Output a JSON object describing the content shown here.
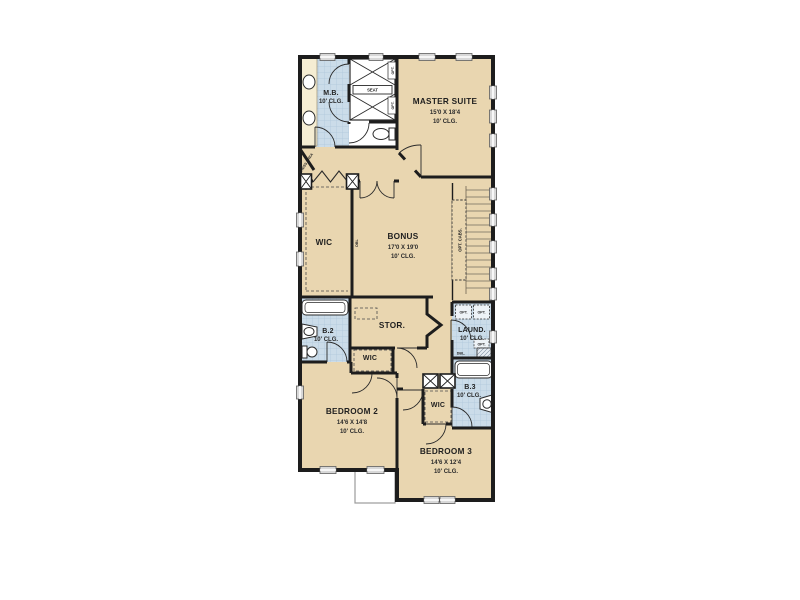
{
  "plan": {
    "type": "residential-floor-plan",
    "colors": {
      "wall": "#1d1d1d",
      "floor_tan": "#e9d6b0",
      "tile_blue": "#cbdce9",
      "vanity_cream": "#f5edd3",
      "background": "#ffffff",
      "window_gray": "#d8d8d8"
    }
  },
  "rooms": {
    "master_bath": {
      "name": "M.B.",
      "ceiling": "10' CLG."
    },
    "master_suite": {
      "name": "MASTER SUITE",
      "dims": "15'0 X 18'4",
      "ceiling": "10' CLG."
    },
    "wic_master": {
      "name": "WIC"
    },
    "bonus": {
      "name": "BONUS",
      "dims": "17'0 X 19'0",
      "ceiling": "10' CLG."
    },
    "bath2": {
      "name": "B.2",
      "ceiling": "10' CLG."
    },
    "storage": {
      "name": "STOR."
    },
    "laundry": {
      "name": "LAUND.",
      "ceiling": "10' CLG."
    },
    "wic_bed2": {
      "name": "WIC"
    },
    "bath3": {
      "name": "B.3",
      "ceiling": "10' CLG."
    },
    "wic_bed3": {
      "name": "WIC"
    },
    "bedroom2": {
      "name": "BEDROOM 2",
      "dims": "14'6 X 14'8",
      "ceiling": "10' CLG."
    },
    "bedroom3": {
      "name": "BEDROOM 3",
      "dims": "14'6 X 12'4",
      "ceiling": "10' CLG."
    }
  },
  "annotations": {
    "seat": "SEAT",
    "dress_area": "DRESS AREA",
    "dbl_master_closet": "DBL",
    "opt_cabs": "OPT. CABS.",
    "opt_washer": "OPT.",
    "opt_dryer": "OPT.",
    "opt_laundry_cab": "OPT.",
    "dbl_laundry": "DBL.",
    "opt_shower_upper": "OPT.",
    "opt_shower_lower": "OPT."
  }
}
